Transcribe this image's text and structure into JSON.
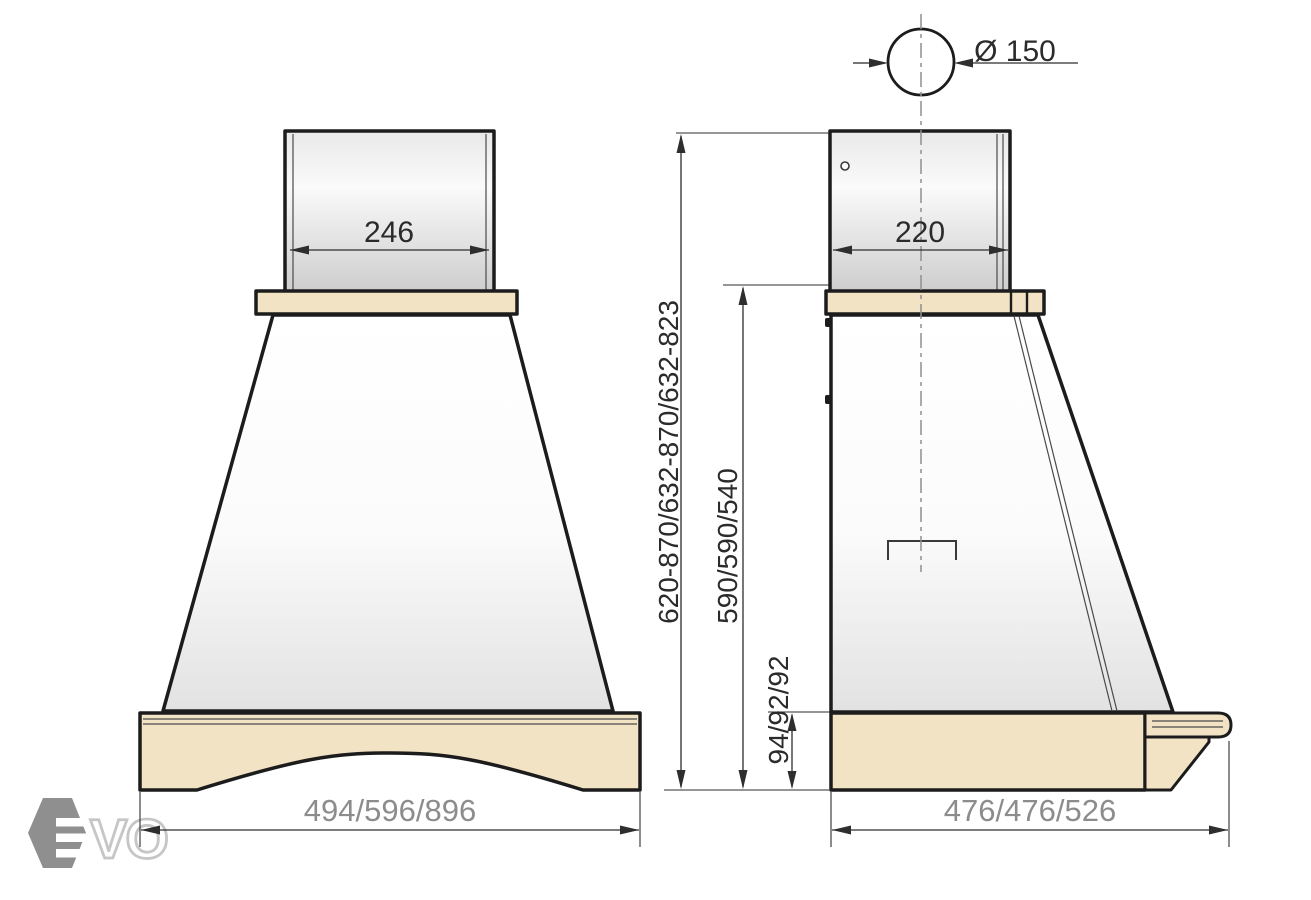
{
  "drawing_title": "cooker-hood-dimension-drawing",
  "dimensions": {
    "front_chimney_width": "246",
    "front_base_width": "494/596/896",
    "side_chimney_depth": "220",
    "side_base_depth": "476/476/526",
    "duct_diameter": "Ø 150",
    "overall_height": "620-870/632-870/632-823",
    "body_height": "590/590/540",
    "base_height": "94/92/92"
  },
  "logo": {
    "letters_outlined": "VO"
  },
  "colors": {
    "outline_black": "#1c1c1c",
    "panel_beige": "#f3e3c5",
    "dim_text_gray": "#8c8c8c",
    "dim_text_dark": "#2b2b2b",
    "logo_gray": "#8f8f8f",
    "logo_letter_outline": "#c6c6c6"
  }
}
